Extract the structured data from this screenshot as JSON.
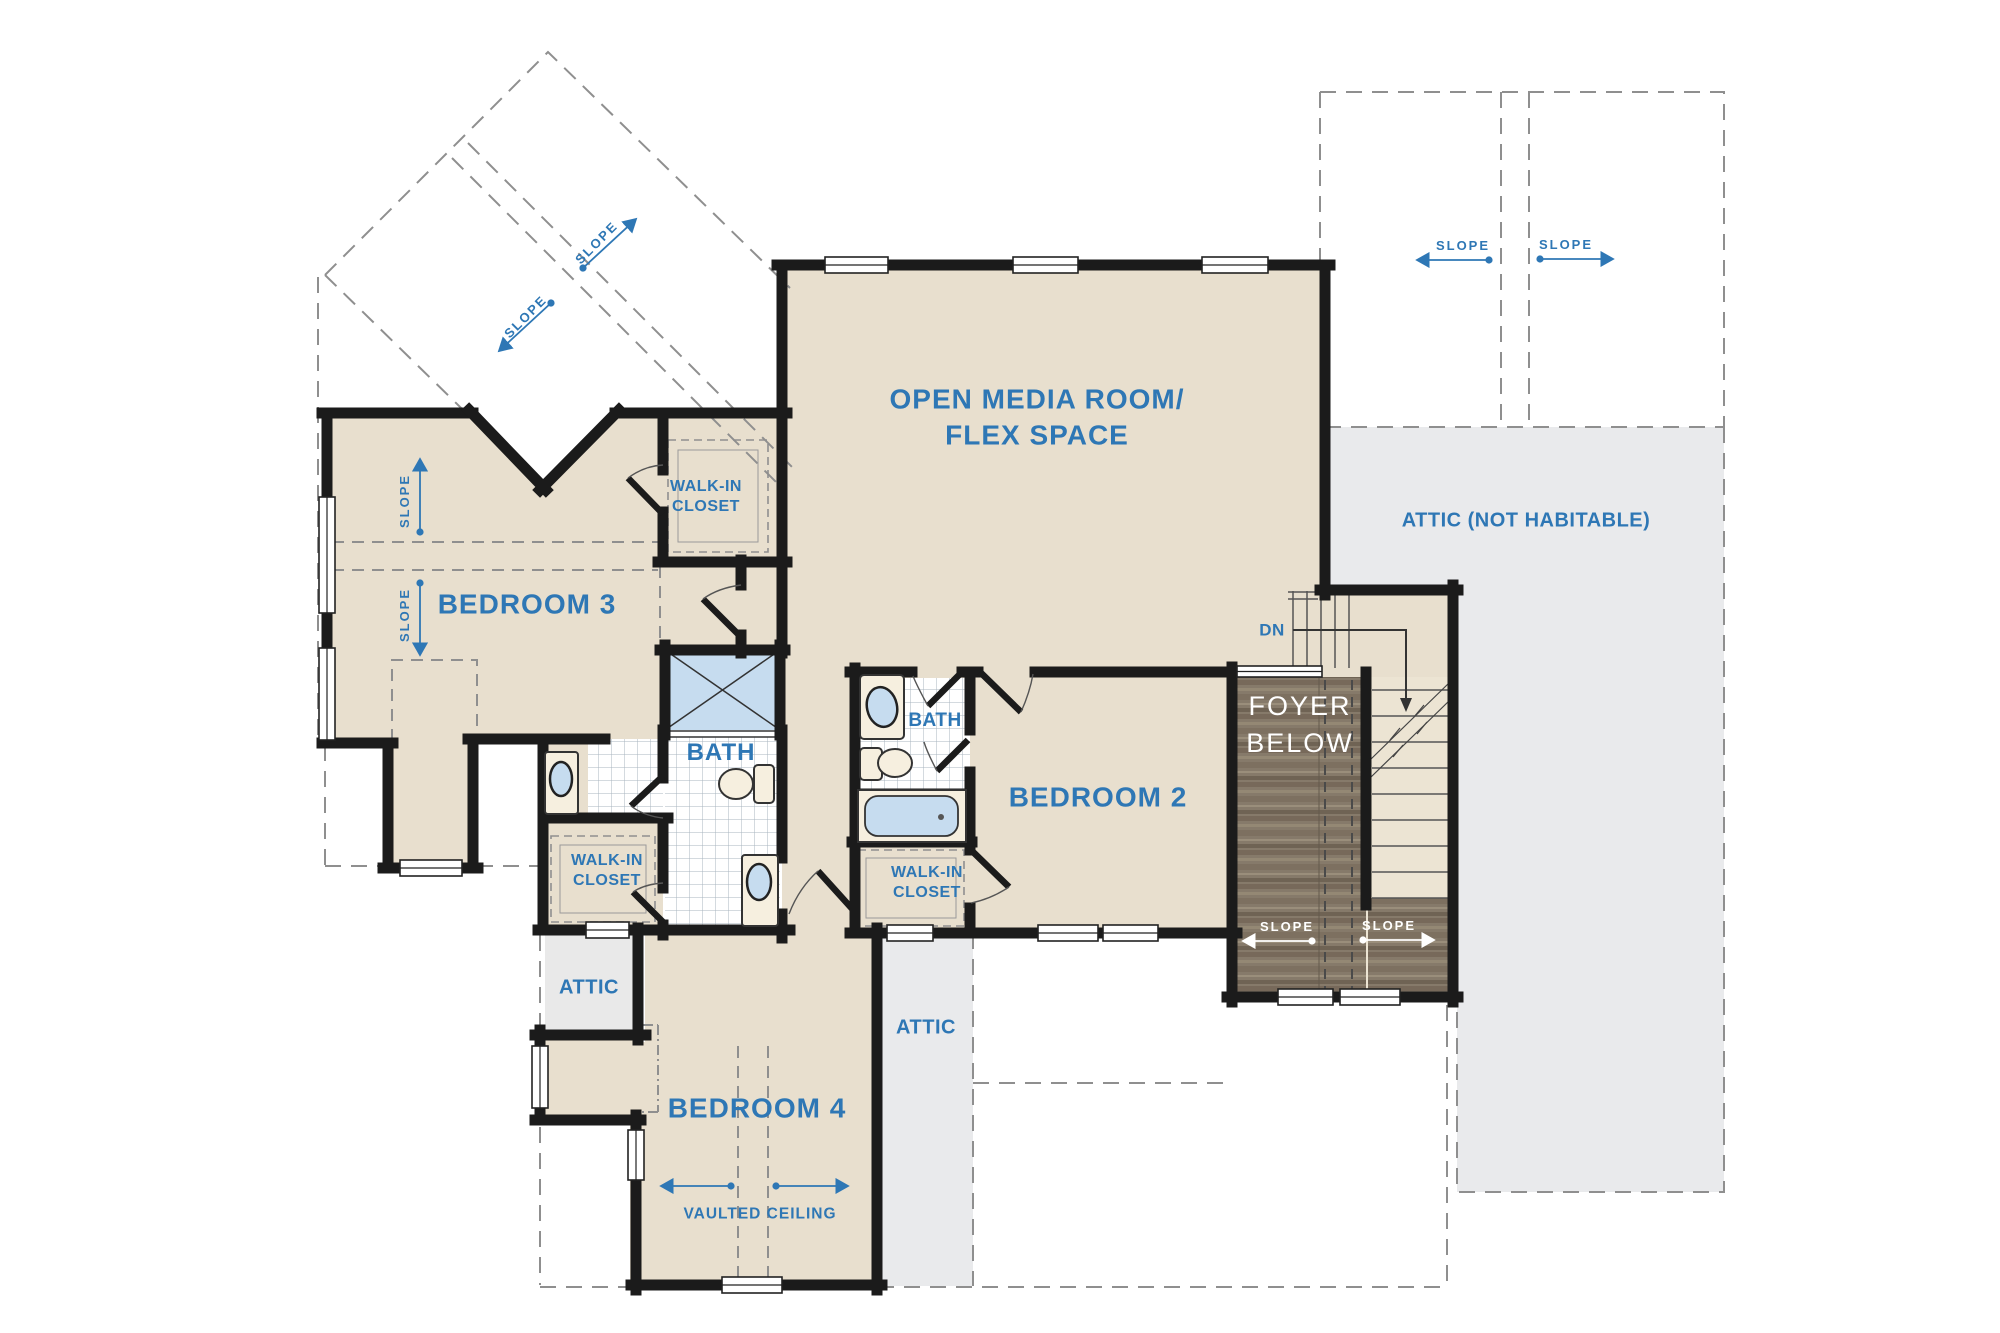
{
  "colors": {
    "accent_blue": "#2e77b5",
    "wall_black": "#1b1b1b",
    "room_beige": "#e8dfce",
    "attic_gray": "#e9eaec",
    "fixture_blue": "#c6dcef",
    "wood_brown": "#867a6a",
    "label_white": "#ffffff"
  },
  "rooms": {
    "open_media_room": {
      "label_line1": "OPEN MEDIA ROOM/",
      "label_line2": "FLEX SPACE"
    },
    "attic_not_habitable": {
      "label": "ATTIC (NOT HABITABLE)"
    },
    "bedroom_3": {
      "label": "BEDROOM 3"
    },
    "bedroom_2": {
      "label": "BEDROOM 2"
    },
    "bedroom_4": {
      "label": "BEDROOM 4"
    },
    "bath_central": {
      "label": "BATH"
    },
    "bath_bedroom2": {
      "label": "BATH"
    },
    "walk_in_closet_1": {
      "line1": "WALK-IN",
      "line2": "CLOSET"
    },
    "walk_in_closet_2": {
      "line1": "WALK-IN",
      "line2": "CLOSET"
    },
    "walk_in_closet_3": {
      "line1": "WALK-IN",
      "line2": "CLOSET"
    },
    "attic_left": {
      "label": "ATTIC"
    },
    "attic_right": {
      "label": "ATTIC"
    },
    "foyer_below": {
      "line1": "FOYER",
      "line2": "BELOW"
    }
  },
  "annotations": {
    "slope": "SLOPE",
    "down": "DN",
    "vaulted_ceiling": "VAULTED CEILING"
  }
}
